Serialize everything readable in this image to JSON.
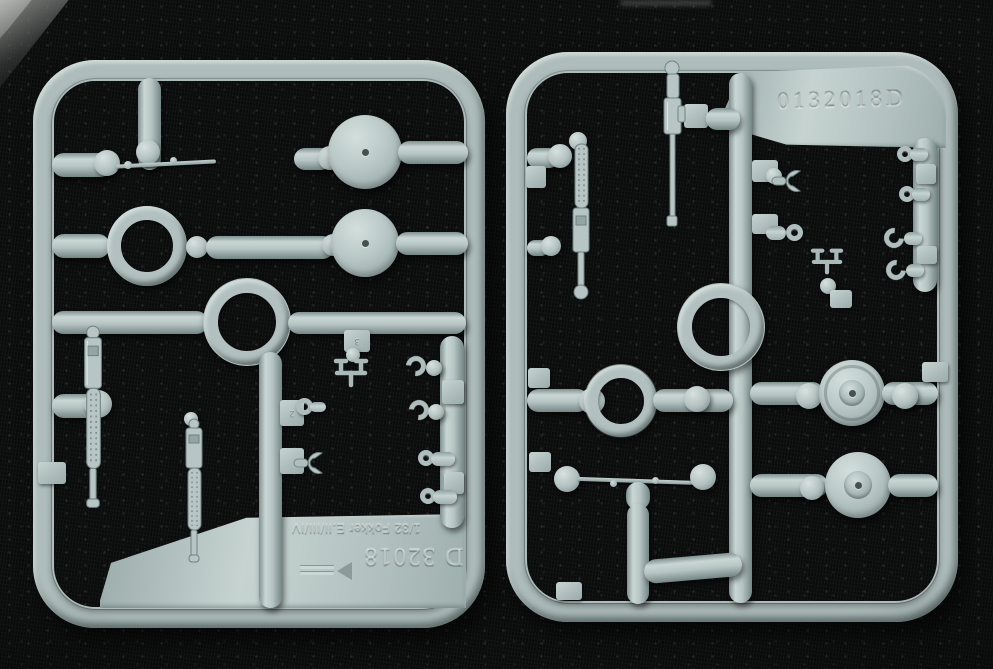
{
  "colors": {
    "background": "#0b0c0c",
    "plastic": "#b4c3c1"
  },
  "left_sprue": {
    "kit_scale_text": "1/32 Fokker E.II/III/IV",
    "kit_number_text": "D 32018",
    "part_tab_numbers": {
      "n2": "2",
      "n3": "3"
    },
    "icons": {
      "logo": "winged-shield-manufacturer-badge"
    }
  },
  "right_sprue": {
    "sprue_code_text": "0132018D"
  }
}
